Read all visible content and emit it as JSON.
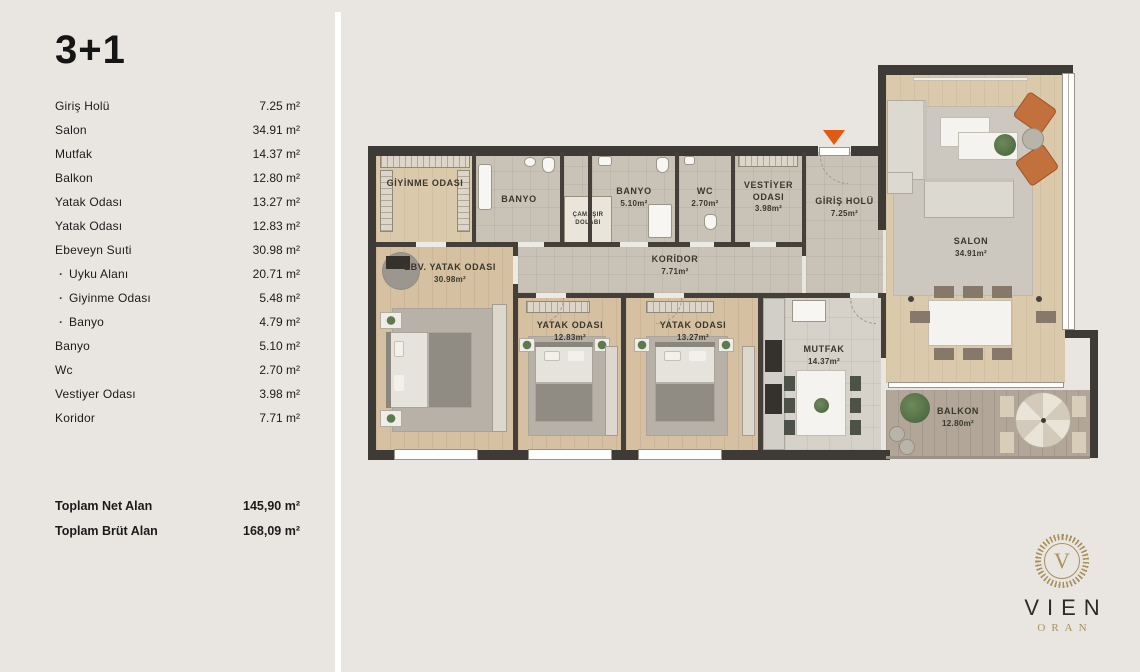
{
  "sidebar": {
    "title": "3+1",
    "sub_bullet": "·",
    "rooms": [
      {
        "label": "Giriş Holü",
        "value": "7.25 m²"
      },
      {
        "label": "Salon",
        "value": "34.91 m²"
      },
      {
        "label": "Mutfak",
        "value": "14.37 m²"
      },
      {
        "label": "Balkon",
        "value": "12.80 m²"
      },
      {
        "label": "Yatak Odası",
        "value": "13.27 m²"
      },
      {
        "label": "Yatak Odası",
        "value": "12.83 m²"
      },
      {
        "label": "Ebeveyn Suıti",
        "value": "30.98 m²"
      },
      {
        "label": "Uyku Alanı",
        "value": "20.71 m²"
      },
      {
        "label": "Giyinme Odası",
        "value": "5.48 m²"
      },
      {
        "label": "Banyo",
        "value": "4.79 m²"
      },
      {
        "label": "Banyo",
        "value": "5.10 m²"
      },
      {
        "label": "Wc",
        "value": "2.70 m²"
      },
      {
        "label": "Vestiyer Odası",
        "value": "3.98 m²"
      },
      {
        "label": "Koridor",
        "value": "7.71 m²"
      }
    ],
    "totals": [
      {
        "label": "Toplam Net Alan",
        "value": "145,90 m²"
      },
      {
        "label": "Toplam Brüt Alan",
        "value": "168,09 m²"
      }
    ]
  },
  "plan": {
    "rooms": {
      "giyinme": {
        "label": "GİYİNME ODASI",
        "area": ""
      },
      "banyo_ebeveyn": {
        "label": "BANYO",
        "area": ""
      },
      "camasir": {
        "label": "ÇAMAŞIR DOLABI",
        "area": ""
      },
      "banyo": {
        "label": "BANYO",
        "area": "5.10m²"
      },
      "wc": {
        "label": "WC",
        "area": "2.70m²"
      },
      "vestiyer": {
        "label": "VESTİYER ODASI",
        "area": "3.98m²"
      },
      "giris": {
        "label": "GİRİŞ HOLÜ",
        "area": "7.25m²"
      },
      "koridor": {
        "label": "KORİDOR",
        "area": "7.71m²"
      },
      "ebv_yatak": {
        "label": "EBV. YATAK ODASI",
        "area": "30.98m²"
      },
      "yatak1": {
        "label": "YATAK ODASI",
        "area": "12.83m²"
      },
      "yatak2": {
        "label": "YATAK ODASI",
        "area": "13.27m²"
      },
      "mutfak": {
        "label": "MUTFAK",
        "area": "14.37m²"
      },
      "salon": {
        "label": "SALON",
        "area": "34.91m²"
      },
      "balkon": {
        "label": "BALKON",
        "area": "12.80m²"
      }
    }
  },
  "logo": {
    "monogram": "V",
    "brand": "VIEN",
    "sub": "ORAN"
  },
  "colors": {
    "background": "#e9e6e1",
    "wall": "#3e3b36",
    "accent_orange": "#e25a12",
    "armchair_orange": "#c2703c",
    "logo_gold": "#aa905c",
    "text": "#1c1c1c"
  }
}
